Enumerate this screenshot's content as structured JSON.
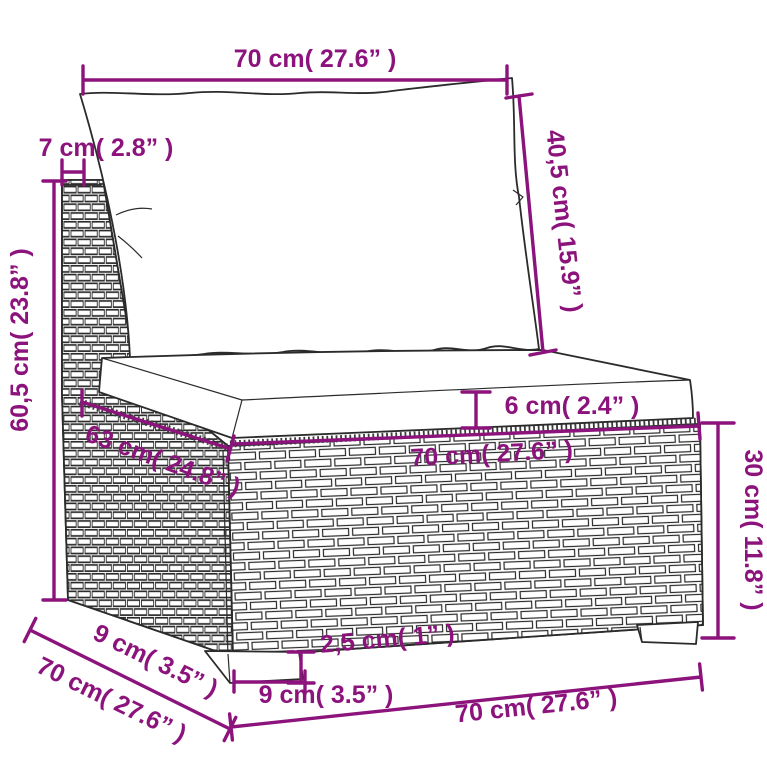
{
  "colors": {
    "dimension": "#8C137C",
    "line_art": "#2b2b2b",
    "background": "#ffffff"
  },
  "drawing": {
    "subject": "wicker-sofa-middle-section-with-cushions",
    "unit_system": "cm and inches"
  },
  "dims": {
    "back_width": {
      "label": "70 cm( 27.6”  )"
    },
    "back_panel_thickness": {
      "label": "7 cm( 2.8”  )"
    },
    "back_cushion_height": {
      "label": "40,5 cm( 15.9”  )"
    },
    "back_total_height": {
      "label": "60,5 cm( 23.8”  )"
    },
    "seat_cushion_thickness": {
      "label": "6 cm( 2.4”  )"
    },
    "seat_depth": {
      "label": "63 cm( 24.8”  )"
    },
    "seat_width": {
      "label": "70 cm( 27.6”  )"
    },
    "base_height": {
      "label": "30 cm( 11.8”  )"
    },
    "foot_depth": {
      "label": "9 cm( 3.5”  )"
    },
    "total_depth": {
      "label": "70 cm( 27.6”  )"
    },
    "foot_height": {
      "label": "2,5 cm( 1”  )"
    },
    "foot_width": {
      "label": "9 cm( 3.5”  )"
    },
    "front_width": {
      "label": "70 cm( 27.6”  )"
    }
  }
}
